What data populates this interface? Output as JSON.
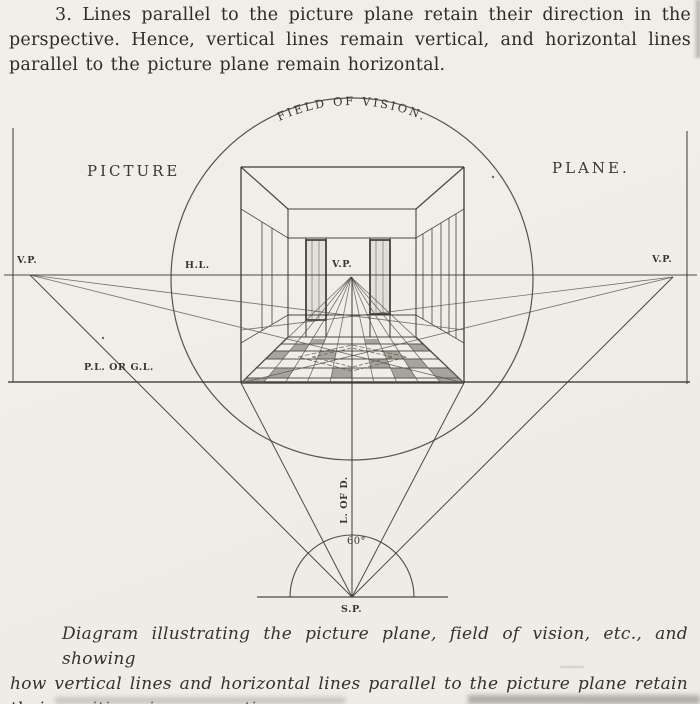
{
  "page": {
    "paragraph_lines": [
      "3. Lines parallel to the picture plane retain their direction in the",
      "perspective.  Hence, vertical lines remain vertical, and horizontal lines",
      "parallel to the picture plane remain horizontal."
    ],
    "caption_lines": [
      "Diagram illustrating the picture plane, field of vision, etc., and showing",
      "how vertical lines and horizontal lines parallel to the picture plane retain",
      "their positions in perspective."
    ]
  },
  "diagram": {
    "labels": {
      "field_of_vision": "FIELD OF VISION.",
      "picture": "PICTURE",
      "plane": "PLANE.",
      "vp_left": "V.P.",
      "vp_center": "V.P.",
      "vp_right": "V.P.",
      "horizon_line": "H.L.",
      "ground_line": "P.L. OR G.L.",
      "line_of_direction": "L. OF D.",
      "cone_angle": "60°",
      "station_point": "S.P."
    },
    "ink_color": "#3b3931",
    "paper_color": "#f0eee8"
  }
}
